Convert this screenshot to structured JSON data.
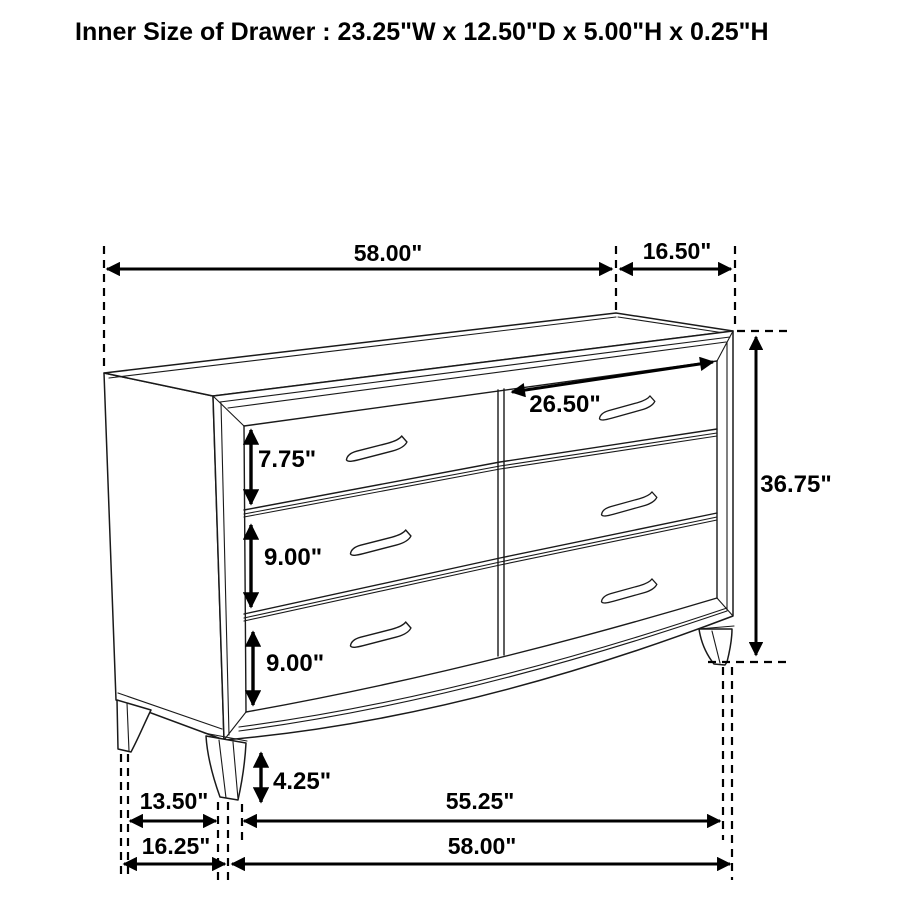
{
  "title": "Inner Size of Drawer : 23.25\"W x 12.50\"D x 5.00\"H x 0.25\"H",
  "diagram": {
    "type": "furniture-dimension-diagram",
    "object": "six-drawer dresser, perspective line drawing",
    "dimensions": {
      "top_width": "58.00\"",
      "top_depth": "16.50\"",
      "overall_height": "36.75\"",
      "top_drawer_height": "7.75\"",
      "middle_drawer_height": "9.00\"",
      "bottom_drawer_height": "9.00\"",
      "drawer_front_width": "26.50\"",
      "leg_height": "4.25\"",
      "leg_clear_span": "13.50\"",
      "front_leg_span": "55.25\"",
      "side_depth": "16.25\"",
      "base_width": "58.00\""
    }
  }
}
